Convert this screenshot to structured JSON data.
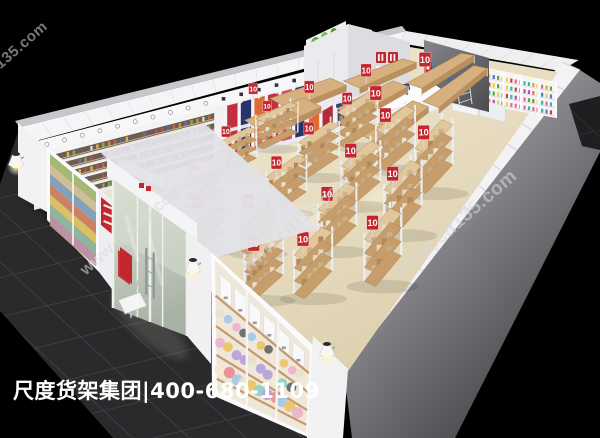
{
  "scene": {
    "caption": "尺度货架集团|400-680-1109",
    "watermark": "www.cd135.com",
    "price_tag": "10",
    "colors": {
      "background": "#000000",
      "tile": "#2a2a2c",
      "tile_grout": "#6b6b72",
      "wall_light": "#f2f2f4",
      "wall_shadow": "#c6c6cb",
      "wall_gray_face": "#909094",
      "interior_floor": "#ece3cb",
      "wood": "#c79d6b",
      "sign_red": "#c1272d",
      "glass": "#c9d1c4",
      "lamp_glow": "#ffe9a8",
      "monitor_blue": "#2c4f91",
      "caption_color": "#ffffff",
      "watermark_color": "#dadadc"
    }
  }
}
